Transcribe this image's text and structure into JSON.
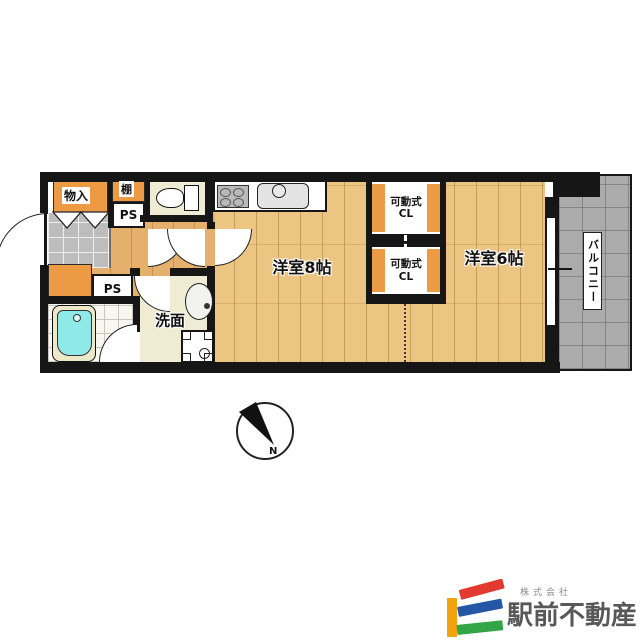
{
  "labels": {
    "storage": "物入",
    "shelf": "棚",
    "pipe_space_top": "PS",
    "pipe_space_bottom": "PS",
    "washroom": "洗面",
    "room_8": "洋室8帖",
    "room_6": "洋室6帖",
    "closet_upper": {
      "line1": "可動式",
      "line2": "CL"
    },
    "closet_lower": {
      "line1": "可動式",
      "line2": "CL"
    },
    "balcony": "バルコニー",
    "compass_north": "N"
  },
  "branding": {
    "company_prefix": "株式会社",
    "company_name": "駅前不動産",
    "mark_colors": {
      "yellow": "#f2a20c",
      "red": "#e23a2e",
      "blue": "#2457a5",
      "green": "#33a447"
    },
    "text_color": "#585858"
  },
  "palette": {
    "wall": "#161616",
    "wood_floor": "#ecc583",
    "hall_floor": "#e5b06c",
    "storage_orange": "#ed9a44",
    "room_cream": "#efecd3",
    "entry_tile_gray": "#bdbdbd",
    "balcony_gray": "#ababab",
    "bath_tile": "#f7f6f1",
    "bathtub_cyan": "#8fe9e6"
  }
}
